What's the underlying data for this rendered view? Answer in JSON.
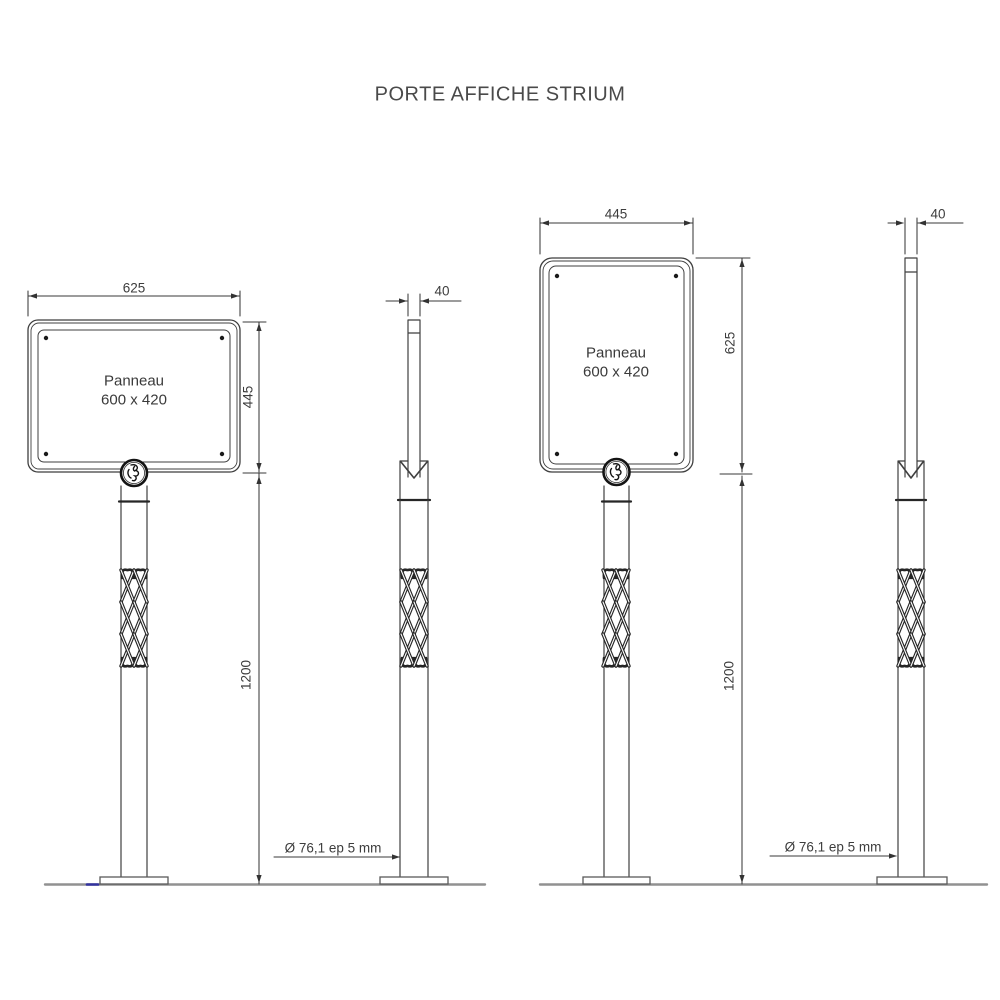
{
  "title": "PORTE AFFICHE STRIUM",
  "drawing": {
    "panel_label_line1": "Panneau",
    "panel_label_line2": "600 x 420",
    "tube_spec": "Ø 76,1 ep 5 mm",
    "dims": {
      "landscape_width": "625",
      "landscape_height": "445",
      "portrait_width": "445",
      "portrait_height": "625",
      "pole_height": "1200",
      "panel_thickness": "40"
    },
    "colors": {
      "line": "#3f3f3f",
      "dimension": "#3a3a3a",
      "ground": "#919191",
      "accent_mark": "#32329f"
    }
  }
}
